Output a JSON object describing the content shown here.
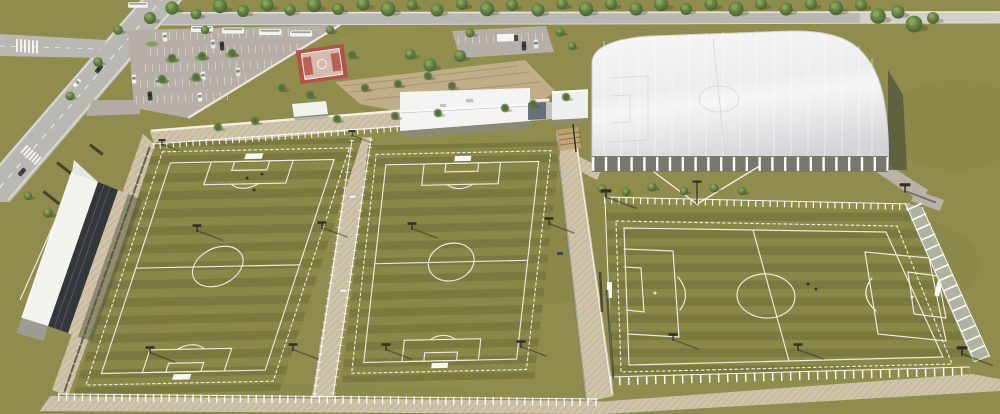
{
  "scene": {
    "description": "Aerial 3D architectural rendering of a football training complex with three outdoor pitches, a covered indoor arena, clubhouse, grandstand, basketball court, parking lots and tree-lined access roads",
    "areas": {
      "access_road": "two-lane access road with crosswalks and side street",
      "top_road": "tree-lined boundary road",
      "main_parking": "triangular visitor parking lot with bus bays",
      "north_parking": "small secondary parking lot with truck bay",
      "basketball_court": "outdoor basketball court",
      "plaza": "entry plaza with promenade walls and timber deck",
      "clubhouse": "white-roofed clubhouse building",
      "service_building": "service block linking clubhouse to arena",
      "indoor_arena": "large indoor hall with translucent barrel roof over a pitch",
      "grandstand": "covered grandstand with white canopy along west pitch",
      "pitch_west": "fenced training pitch with floodlights",
      "pitch_center": "fenced training pitch with floodlights",
      "pitch_east": "fenced match pitch with perimeter rail fence",
      "walkways": "paved walkway ring around the pitches",
      "landscaping": "rows of trees and palm planting"
    },
    "counts": {
      "outdoor_pitches": 3,
      "indoor_pitches": 1,
      "grandstands": 1,
      "basketball_courts": 1,
      "parking_lots": 2
    }
  },
  "colors": {
    "grass": "#8f8c4d",
    "grassDark": "#6f6d39",
    "grassLight": "#a29e5e",
    "pitchA": "#8a8848",
    "pitchB": "#7a793f",
    "line": "#eeeadb",
    "walk": "#cfc4aa",
    "walkLine": "#b3a283",
    "road": "#b9b8b2",
    "roadEdge": "#d8d8d3",
    "parking": "#b5afa7",
    "domeHi": "#f8f8f9",
    "domeLo": "#d6d6d9",
    "domeRib": "#77776b",
    "roofWhite": "#f4f4f3",
    "standDark": "#33363a",
    "canopy": "#f3f3f0",
    "courtRed": "#b35248",
    "courtInner": "#d8b9ad",
    "treeDark": "#46632f",
    "treeLight": "#7d9a52",
    "palm": "#57743c",
    "fenceWhite": "#ffffff",
    "mesh": "#333b28",
    "deck": "#c8b492",
    "metal": "#2e2f28",
    "shadow": "#50533a"
  }
}
